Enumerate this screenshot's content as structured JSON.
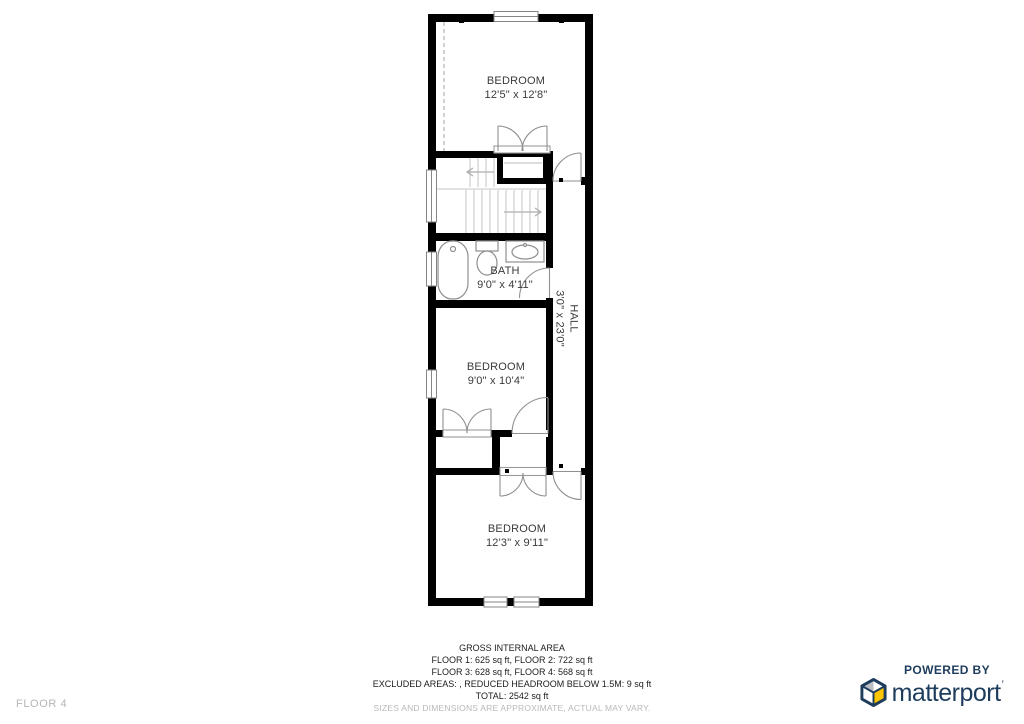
{
  "floor_indicator": "FLOOR 4",
  "rooms": {
    "bedroom_top": {
      "name": "BEDROOM",
      "dims": "12'5\" x 12'8\""
    },
    "bath": {
      "name": "BATH",
      "dims": "9'0\" x 4'11\""
    },
    "hall": {
      "name": "HALL",
      "dims": "3'0\" x 23'0\""
    },
    "bedroom_mid": {
      "name": "BEDROOM",
      "dims": "9'0\" x 10'4\""
    },
    "bedroom_bottom": {
      "name": "BEDROOM",
      "dims": "12'3\" x 9'11\""
    }
  },
  "area_summary": {
    "title": "GROSS INTERNAL AREA",
    "floors_line_1": "FLOOR 1: 625 sq ft, FLOOR 2: 722 sq ft",
    "floors_line_2": "FLOOR 3: 628 sq ft, FLOOR 4: 568 sq ft",
    "excluded_line": "EXCLUDED AREAS: , REDUCED HEADROOM BELOW 1.5M: 9 sq ft",
    "total_line": "TOTAL: 2542 sq ft",
    "disclaimer": "SIZES AND DIMENSIONS ARE APPROXIMATE, ACTUAL MAY VARY."
  },
  "branding": {
    "powered_by": "POWERED BY",
    "brand_name": "matterport",
    "brand_mark": "’"
  },
  "colors": {
    "wall": "#000000",
    "brand_navy": "#1e3c5c",
    "cube_yellow": "#fdc500",
    "cube_gray": "#b9bfc4",
    "muted_text": "#b9b9b9"
  }
}
